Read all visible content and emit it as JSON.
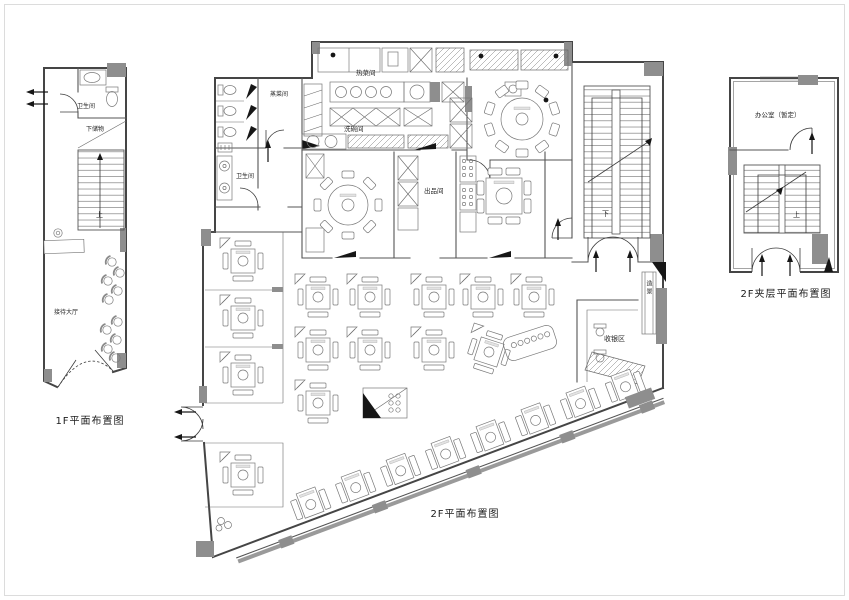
{
  "sheet": {
    "plans": [
      {
        "id": "f1",
        "title": "1F平面布置图",
        "rooms": {
          "bathroom": "卫生间",
          "understair_storage": "下储物",
          "stair_direction": "上",
          "reception_hall": "接待大厅"
        }
      },
      {
        "id": "f2",
        "title": "2F平面布置图",
        "rooms": {
          "steam_room": "蒸菜间",
          "hot_kitchen": "热菜间",
          "dishwashing": "洗碗间",
          "bathroom": "卫生间",
          "expo_room": "出品间",
          "stair_direction": "下",
          "cashier_area": "收银区",
          "scenery": "造景"
        }
      },
      {
        "id": "mezz",
        "title": "2F夹层平面布置图",
        "rooms": {
          "office": "办公室（暂定）",
          "stair_direction": "上"
        }
      }
    ],
    "colors": {
      "wall_line": "#454545",
      "wall_fill": "#8e8e8e",
      "furniture_line": "#787878",
      "background": "#ffffff"
    }
  }
}
